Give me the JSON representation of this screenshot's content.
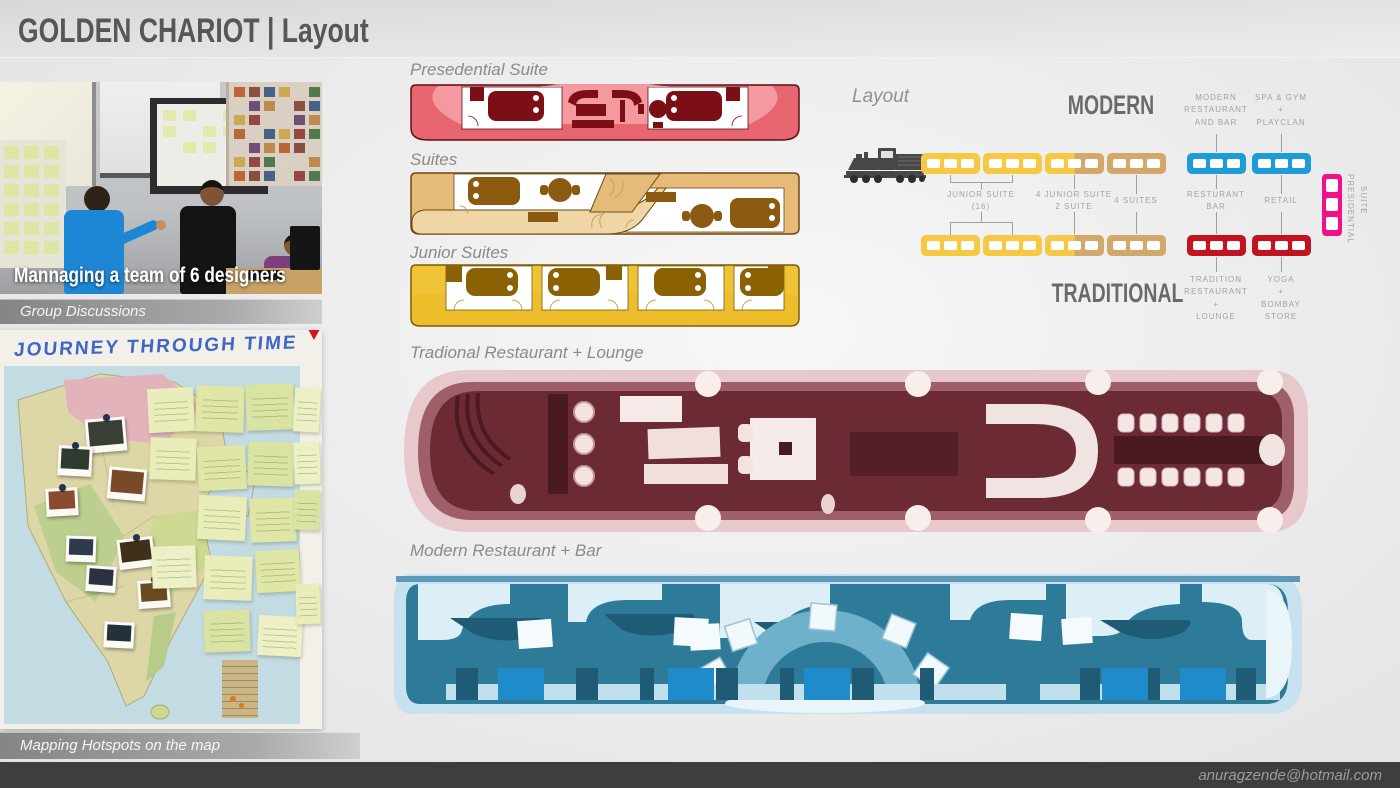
{
  "slide": {
    "title": "GOLDEN CHARIOT | Layout",
    "email": "anuragzende@hotmail.com"
  },
  "left_column": {
    "team_photo": {
      "overlay_text": "Mannaging a team of 6 designers",
      "caption": "Group Discussions"
    },
    "map_photo": {
      "handwritten_title": "JOURNEY THROUGH TIME",
      "caption": "Mapping Hotspots on the map"
    }
  },
  "floor_plans": [
    {
      "id": "presidential",
      "label": "Presedential Suite",
      "body_color": "#E8666F",
      "light_color": "#F4999F",
      "furniture_color": "#7C0F16"
    },
    {
      "id": "suites",
      "label": "Suites",
      "body_color": "#E6BA79",
      "light_color": "#F0D6A4",
      "furniture_color": "#8B5A10"
    },
    {
      "id": "junior_suites",
      "label": "Junior Suites",
      "body_color": "#F0C236",
      "light_color": "#F6DB6C",
      "furniture_color": "#8A6203"
    },
    {
      "id": "traditional_restaurant",
      "label": "Tradional Restaurant + Lounge",
      "body_color": "#6C2A35",
      "shell_color": "#E7C9CD",
      "furniture_color": "#F6E9E8"
    },
    {
      "id": "modern_restaurant",
      "label": "Modern Restaurant + Bar",
      "body_color": "#2E7A99",
      "shell_color": "#C6E2EF",
      "accent_color": "#1E8BCB"
    }
  ],
  "layout_diagram": {
    "title": "Layout",
    "heading_top": "MODERN",
    "heading_bottom": "TRADITIONAL",
    "car_colors": {
      "junior": "#F7C843",
      "suite": "#D2A96B",
      "modern": "#1E9CD7",
      "traditional": "#C2131E",
      "presidential": "#F0108C"
    },
    "rows": {
      "top": [
        "junior",
        "junior",
        "split",
        "suite",
        "modern",
        "modern"
      ],
      "bottom": [
        "junior",
        "junior",
        "split",
        "suite",
        "traditional",
        "traditional"
      ]
    },
    "top_labels": [
      {
        "lines": [
          "MODERN",
          "RESTAURANT",
          "AND BAR"
        ]
      },
      {
        "lines": [
          "SPA & GYM",
          "+",
          "PLAYCLAN"
        ]
      }
    ],
    "mid_labels": [
      {
        "lines": [
          "JUNIOR SUITE",
          "(16)"
        ]
      },
      {
        "lines": [
          "4 JUNIOR SUITE",
          "2 SUITE"
        ]
      },
      {
        "lines": [
          "4 SUITES"
        ]
      },
      {
        "lines": [
          "RESTURANT",
          "BAR"
        ]
      },
      {
        "lines": [
          "RETAIL"
        ]
      }
    ],
    "bottom_labels": [
      {
        "lines": [
          "TRADITION",
          "RESTAURANT",
          "+",
          "LOUNGE"
        ]
      },
      {
        "lines": [
          "YOGA",
          "+",
          "BOMBAY",
          "STORE"
        ]
      }
    ],
    "presidential_label_line1": "PRESIDENTIAL",
    "presidential_label_line2": "SUITE"
  }
}
